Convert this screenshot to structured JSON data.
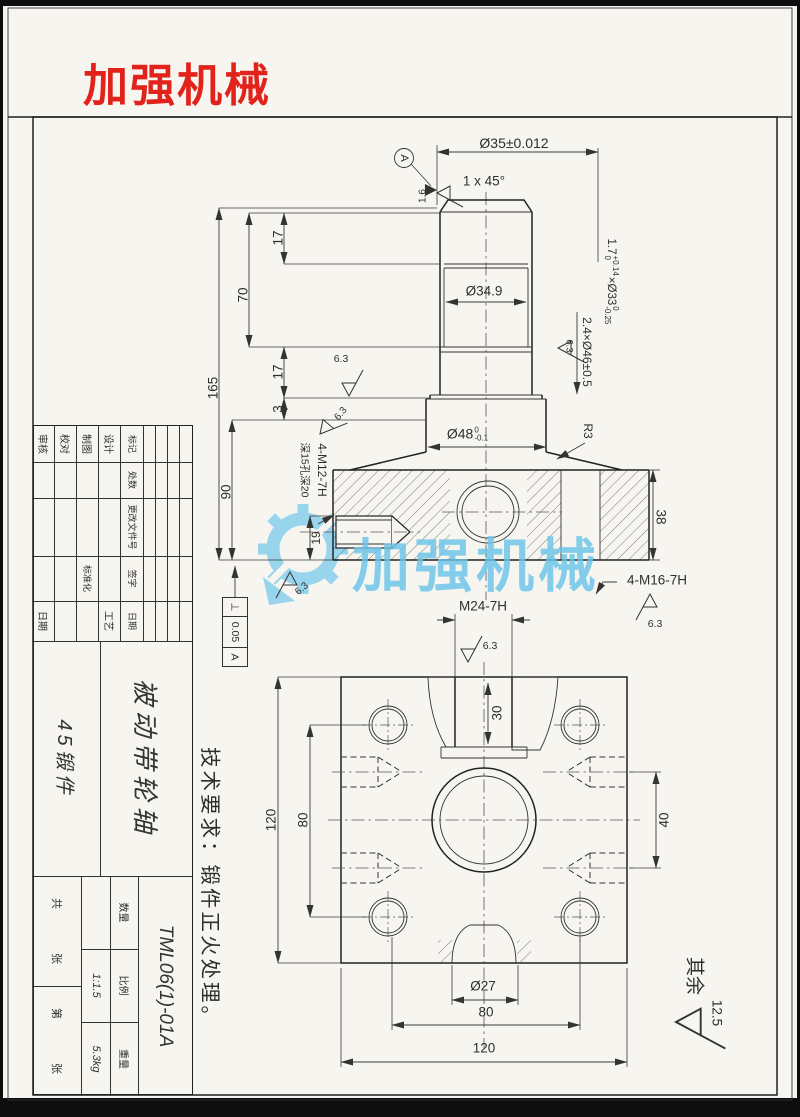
{
  "logo": "加强机械",
  "watermark": "加强机械",
  "front": {
    "datum": "A",
    "dim_d35": "Ø35±0.012",
    "chamfer": "1 x 45°",
    "dim_d349": "Ø34.9",
    "groove1": {
      "w": "1.7",
      "w_up": "+0.14",
      "w_dn": "0",
      "d": "×Ø33",
      "d_up": "0",
      "d_dn": "-0.25"
    },
    "groove2": "2.4×Ø46±0.5",
    "d165": "165",
    "d70": "70",
    "d17a": "17",
    "d17b": "17",
    "d3": "3",
    "d90": "90",
    "d19": "19",
    "d38": "38",
    "d48": {
      "base": "Ø48",
      "up": "0",
      "dn": "-0.1"
    },
    "r3": "R3",
    "m12_label": "4-M12-7H",
    "m12_note": "深15孔深20",
    "m16_label": "4-M16-7H",
    "gdt": {
      "sym": "⊥",
      "val": "0.05",
      "ref": "A"
    }
  },
  "plan": {
    "m24": "M24-7H",
    "d30": "30",
    "d120_left": "120",
    "d80_left": "80",
    "d40": "40",
    "d27": "Ø27",
    "d80_bottom": "80",
    "d120_bottom": "120"
  },
  "finish": {
    "v16": "1.6",
    "v63": "6.3",
    "v125": "12.5"
  },
  "notes": {
    "tech": "技术要求：锻件正火处理。",
    "rest": "其余"
  },
  "title_block": {
    "rev": [
      "标记",
      "处数",
      "更改文件号",
      "签字",
      "日期"
    ],
    "sig_left": [
      "设计",
      "制图",
      "校对",
      "审核"
    ],
    "sig_right": [
      "工艺",
      "标准化",
      "日期"
    ],
    "name": "被动带轮轴",
    "material": "45锻件",
    "number": "TML06(1)-01A",
    "labels": {
      "qty": "数量",
      "scale": "比例",
      "weight": "重量"
    },
    "scale": "1:1.5",
    "weight": "5.3kg",
    "sheet": [
      "共",
      "张",
      "第",
      "张"
    ]
  }
}
